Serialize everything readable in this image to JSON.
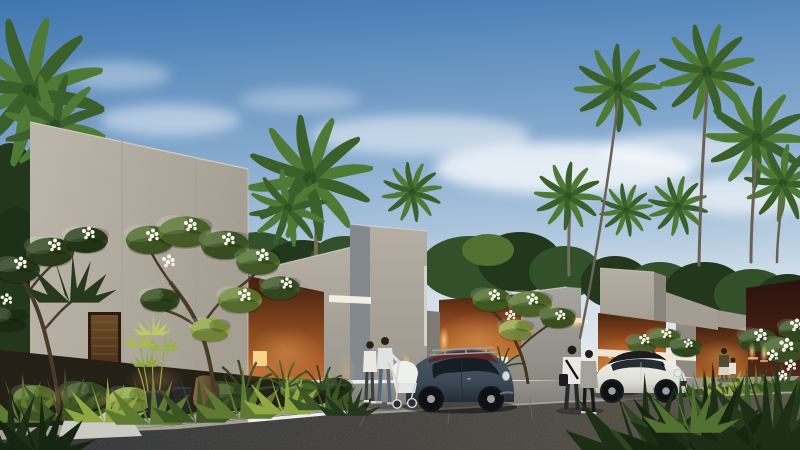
{
  "scene": {
    "setting": "modern tropical villa complex at dusk",
    "time_of_day": "dusk",
    "villa_count": 5,
    "materials": [
      "speckled terrazzo concrete",
      "warm-lit brick",
      "dark maroon stone"
    ],
    "vegetation": [
      "fan palm trees",
      "frangipani trees with white blossoms",
      "uplit tropical garden beds",
      "foreground grasses"
    ],
    "cars": [
      {
        "model": "beetle-hatchback",
        "body_color": "dark slate blue",
        "roof_color": "dark red",
        "detail": "silver roof rack"
      },
      {
        "model": "mini-cooper",
        "body_color": "white",
        "roof_color": "black"
      }
    ],
    "people": [
      {
        "group": "couple-with-white-stroller",
        "position": "center, beside dark car"
      },
      {
        "group": "walking-couple",
        "position": "center-right on road"
      },
      {
        "group": "woman-with-child",
        "position": "far right near brick wall"
      }
    ]
  },
  "colors": {
    "sky-top": "#3f76b0",
    "sky-mid": "#9dbbd8",
    "sky-low": "#e7ecef",
    "cloud": "#ffffff",
    "concrete-light": "#bdb6aa",
    "concrete-mid": "#a7a198",
    "concrete-shade": "#8e9094",
    "concrete-dark": "#7d7973",
    "brick-lit": "#d88a3e",
    "brick-mid": "#a05323",
    "brick-dark": "#4a2310",
    "maroon-top": "#2a130d",
    "maroon-low": "#5c2b1c",
    "door-wood": "#5f4022",
    "road-dark": "#313336",
    "road-warm": "#5b5549",
    "pavement": "#92918c",
    "curb": "#b7b5ad",
    "path": "#cbcbc3",
    "soil": "#241f17",
    "tree-dark": "#22371c",
    "tree-mid": "#32502a",
    "tree-lit": "#527031",
    "palm1": "#4f7a36",
    "palm2": "#3a5f2a",
    "trunk": "#756c5c",
    "leaf-lit": "#b9bc55",
    "leaf-bright": "#8fa844",
    "leaf-mid": "#5d7a30",
    "leaf-dark": "#3c5526",
    "leaf-deep": "#24361c",
    "flower": "#f6f3ea",
    "glow": "#ffc476",
    "window-warm": "#f7d488",
    "slit-white": "#f3efe3",
    "beetle-body": "#3c4a57",
    "beetle-roof": "#5c2823",
    "window-dark": "#141b22",
    "mini-body": "#eaebe5",
    "mini-roof": "#1a1c1f",
    "wheel": "#0f1011",
    "hub": "#9aa0a5",
    "shirt-light": "#dfe3e2",
    "shirt-white": "#eae8e0",
    "jeans": "#51677f",
    "pants-dark": "#25282d",
    "top-gray": "#a5a29c",
    "hair": "#2b2014",
    "stroller": "#eef0ee"
  }
}
